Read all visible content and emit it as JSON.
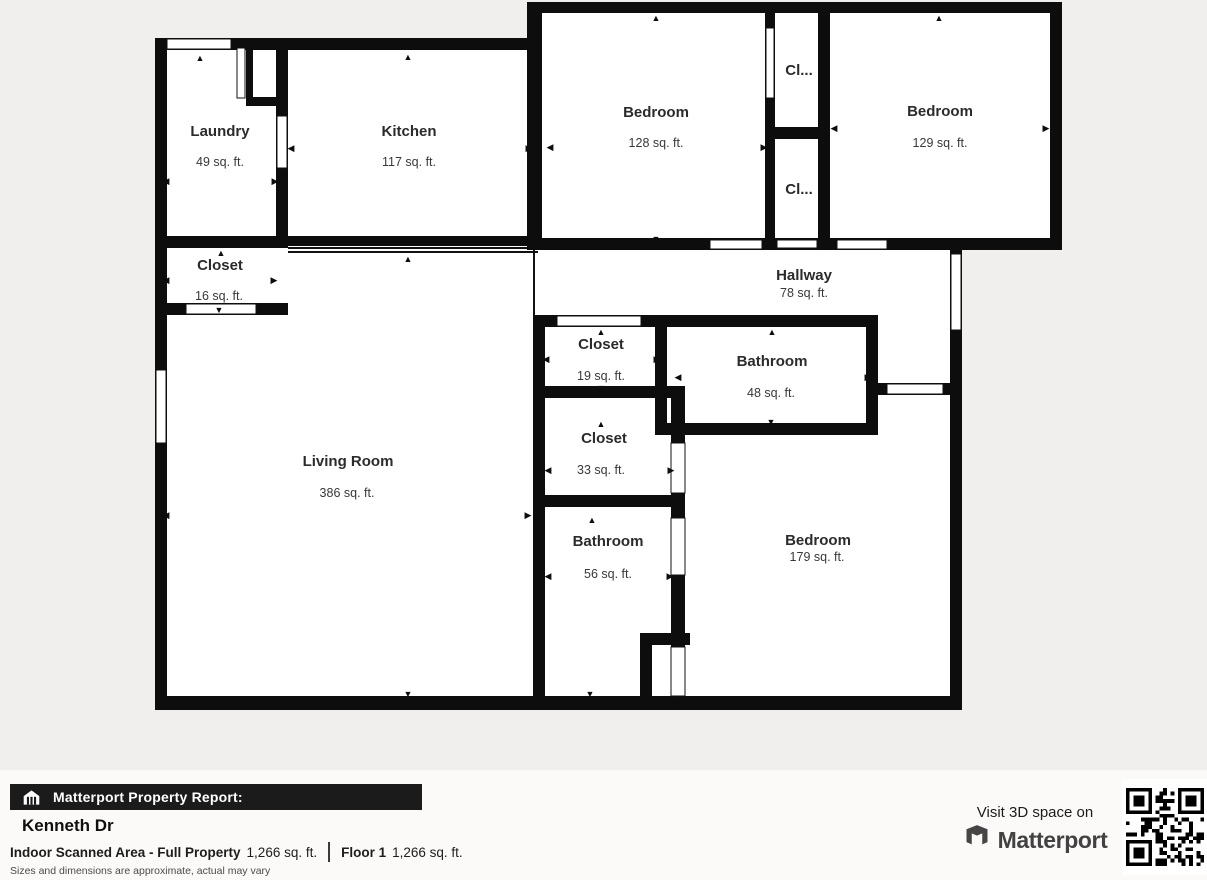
{
  "page": {
    "background": "#f0efed",
    "footer_background": "#fbfaf8",
    "wall_color": "#0d0d0d",
    "room_fill": "#ffffff"
  },
  "floorplan": {
    "rooms": [
      {
        "id": "laundry",
        "name": "Laundry",
        "area": "49 sq. ft."
      },
      {
        "id": "kitchen",
        "name": "Kitchen",
        "area": "117 sq. ft."
      },
      {
        "id": "bedroom-1",
        "name": "Bedroom",
        "area": "128 sq. ft."
      },
      {
        "id": "closet-top",
        "name": "Cl...",
        "area": ""
      },
      {
        "id": "closet-bottom",
        "name": "Cl...",
        "area": ""
      },
      {
        "id": "bedroom-2",
        "name": "Bedroom",
        "area": "129 sq. ft."
      },
      {
        "id": "closet-16",
        "name": "Closet",
        "area": "16 sq. ft."
      },
      {
        "id": "hallway",
        "name": "Hallway",
        "area": "78 sq. ft."
      },
      {
        "id": "closet-19",
        "name": "Closet",
        "area": "19 sq. ft."
      },
      {
        "id": "bathroom-48",
        "name": "Bathroom",
        "area": "48 sq. ft."
      },
      {
        "id": "closet-33",
        "name": "Closet",
        "area": "33 sq. ft."
      },
      {
        "id": "bathroom-56",
        "name": "Bathroom",
        "area": "56 sq. ft."
      },
      {
        "id": "bedroom-3",
        "name": "Bedroom",
        "area": "179 sq. ft."
      },
      {
        "id": "living-room",
        "name": "Living Room",
        "area": "386 sq. ft."
      }
    ]
  },
  "report": {
    "bar_label": "Matterport Property Report:",
    "property_name": "Kenneth Dr",
    "scanned_area_label": "Indoor Scanned Area - Full Property",
    "scanned_area_value": "1,266 sq. ft.",
    "floor_label": "Floor 1",
    "floor_value": "1,266 sq. ft.",
    "disclaimer": "Sizes and dimensions are approximate, actual may vary"
  },
  "cta": {
    "visit_text": "Visit 3D space on",
    "brand": "Matterport"
  },
  "icons": {
    "arrow_up": "▲",
    "arrow_down": "▼",
    "arrow_left": "◀",
    "arrow_right": "▶"
  }
}
